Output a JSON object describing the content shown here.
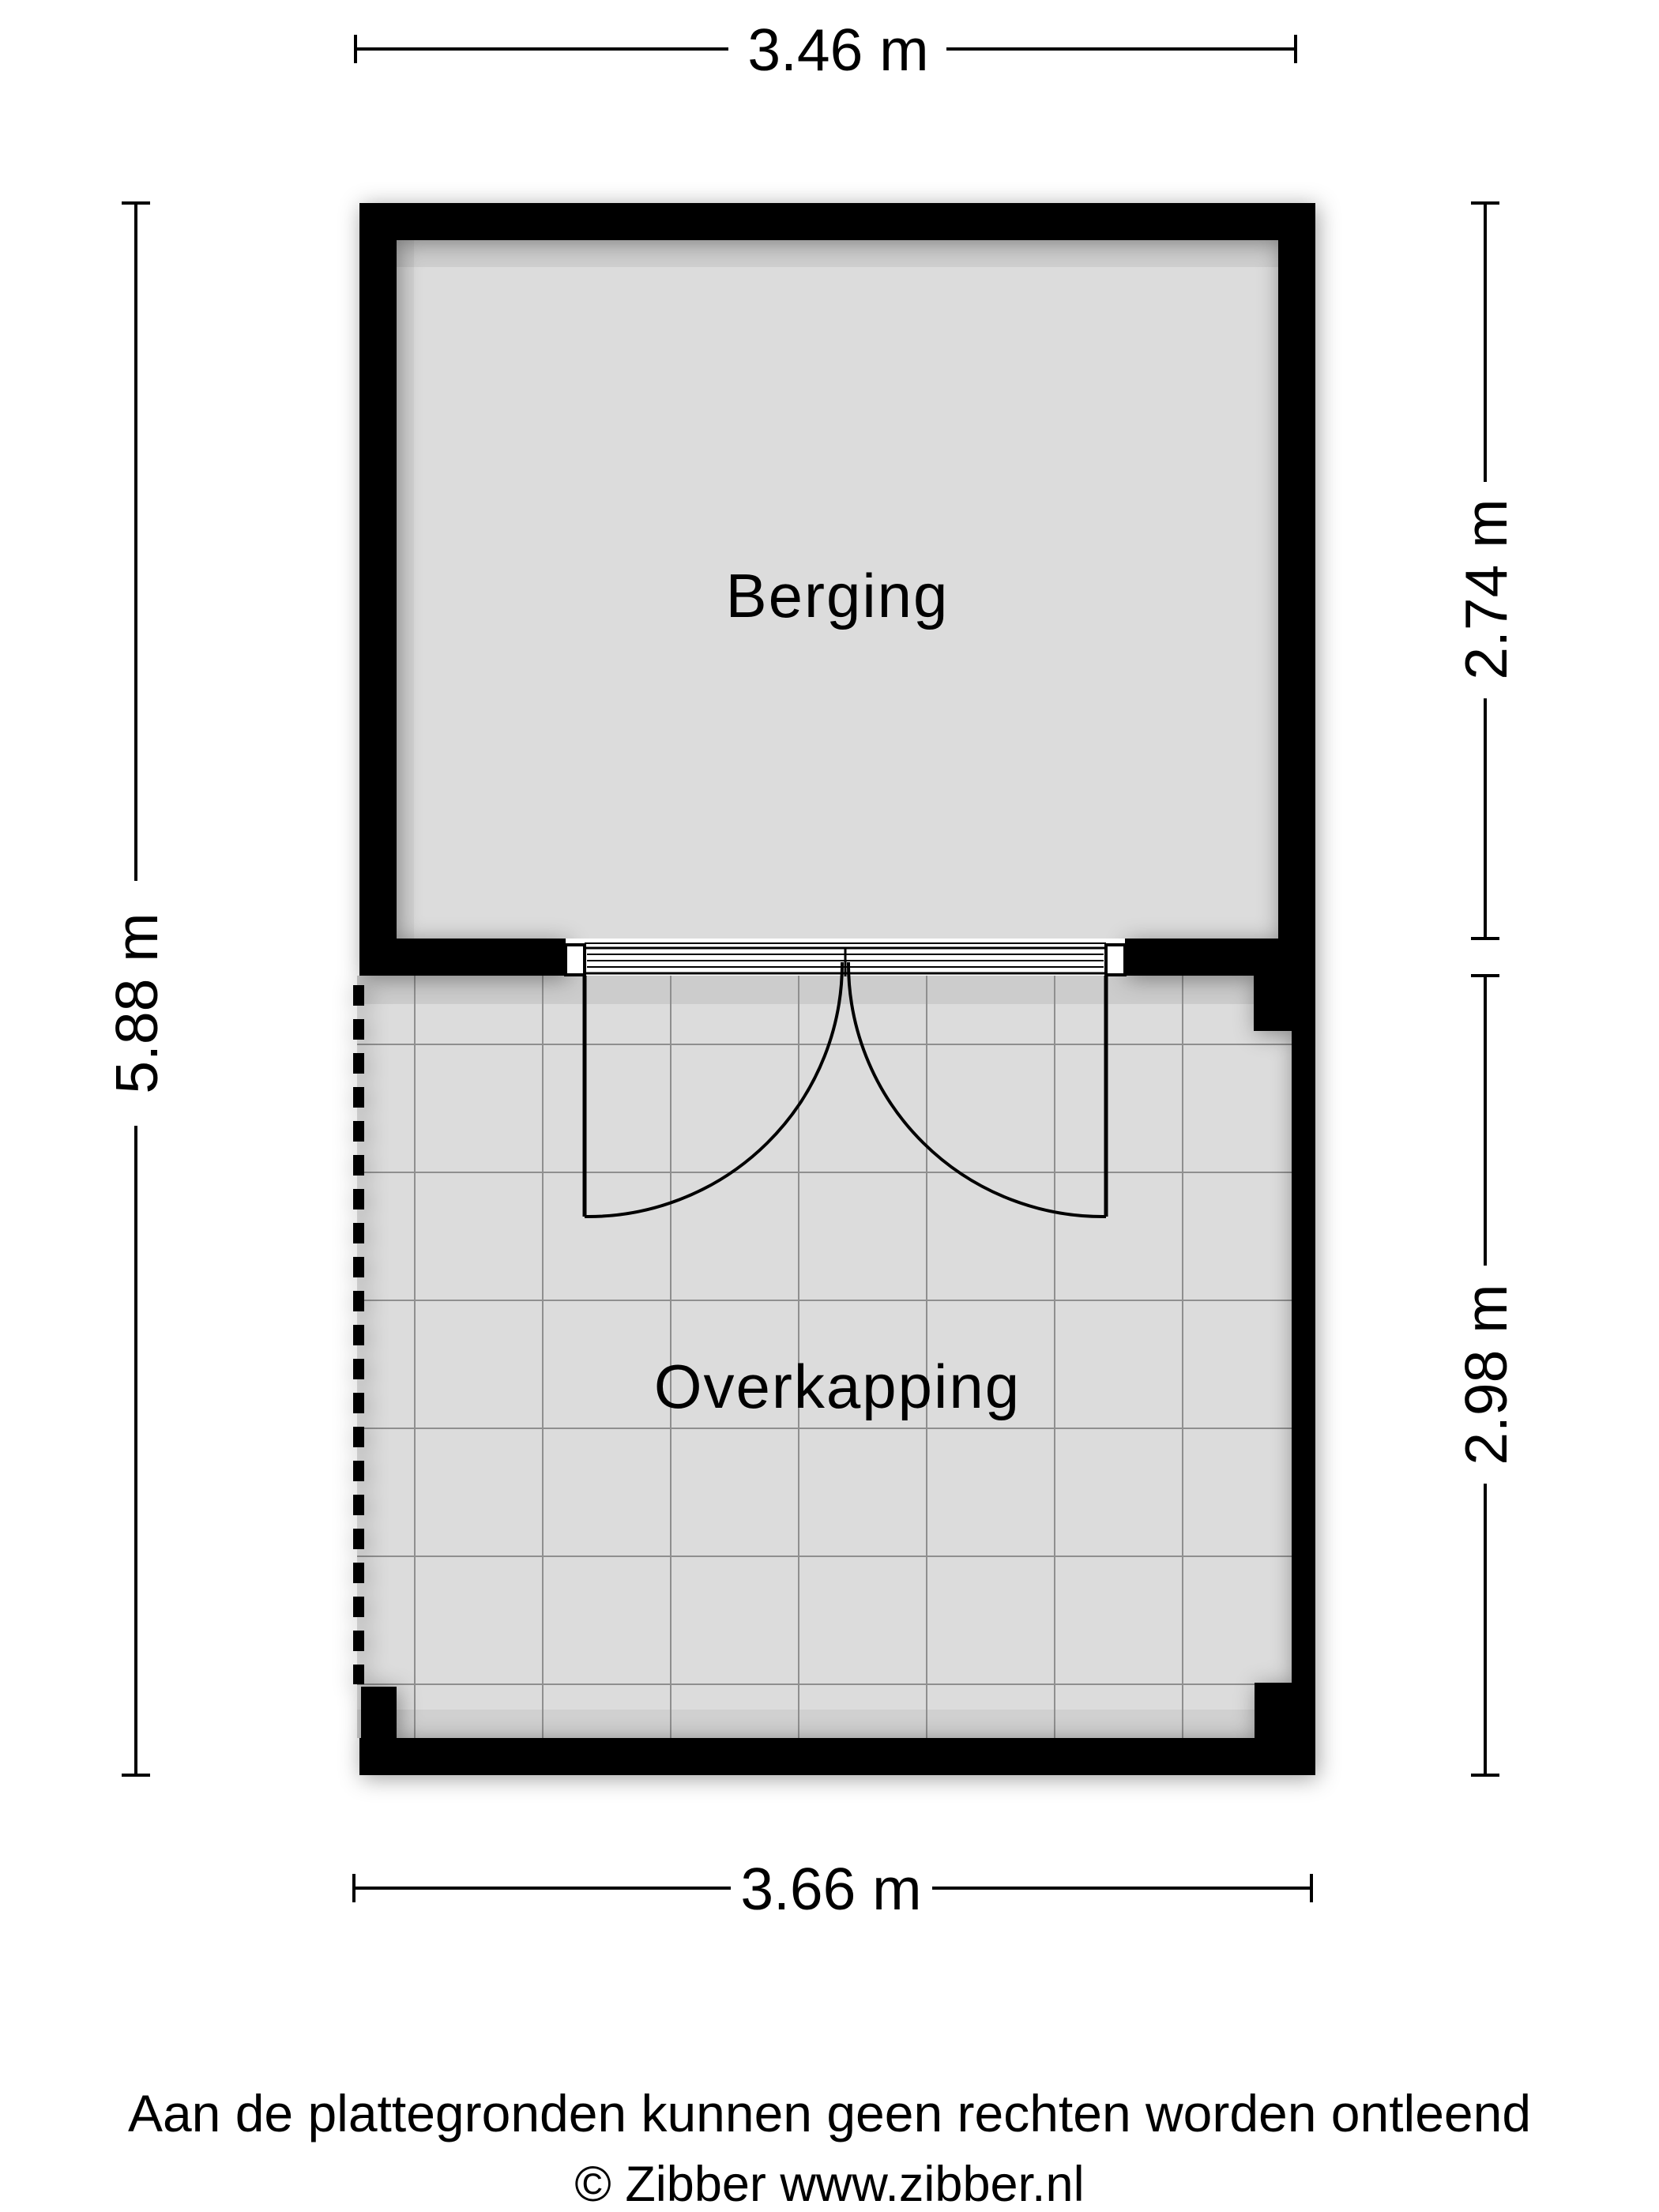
{
  "plan": {
    "rooms": [
      {
        "name": "Berging"
      },
      {
        "name": "Overkapping"
      }
    ],
    "dimensions": {
      "top": "3.46 m",
      "left": "5.88 m",
      "right_top": "2.74 m",
      "right_bottom": "2.98 m",
      "bottom": "3.66 m"
    }
  },
  "footer": {
    "disclaimer": "Aan de plattegronden kunnen geen rechten worden ontleend",
    "copyright": "© Zibber www.zibber.nl"
  },
  "colors": {
    "wall": "#000000",
    "floor": "#dcdcdc",
    "grid": "#8f8f8f",
    "background": "#ffffff"
  }
}
